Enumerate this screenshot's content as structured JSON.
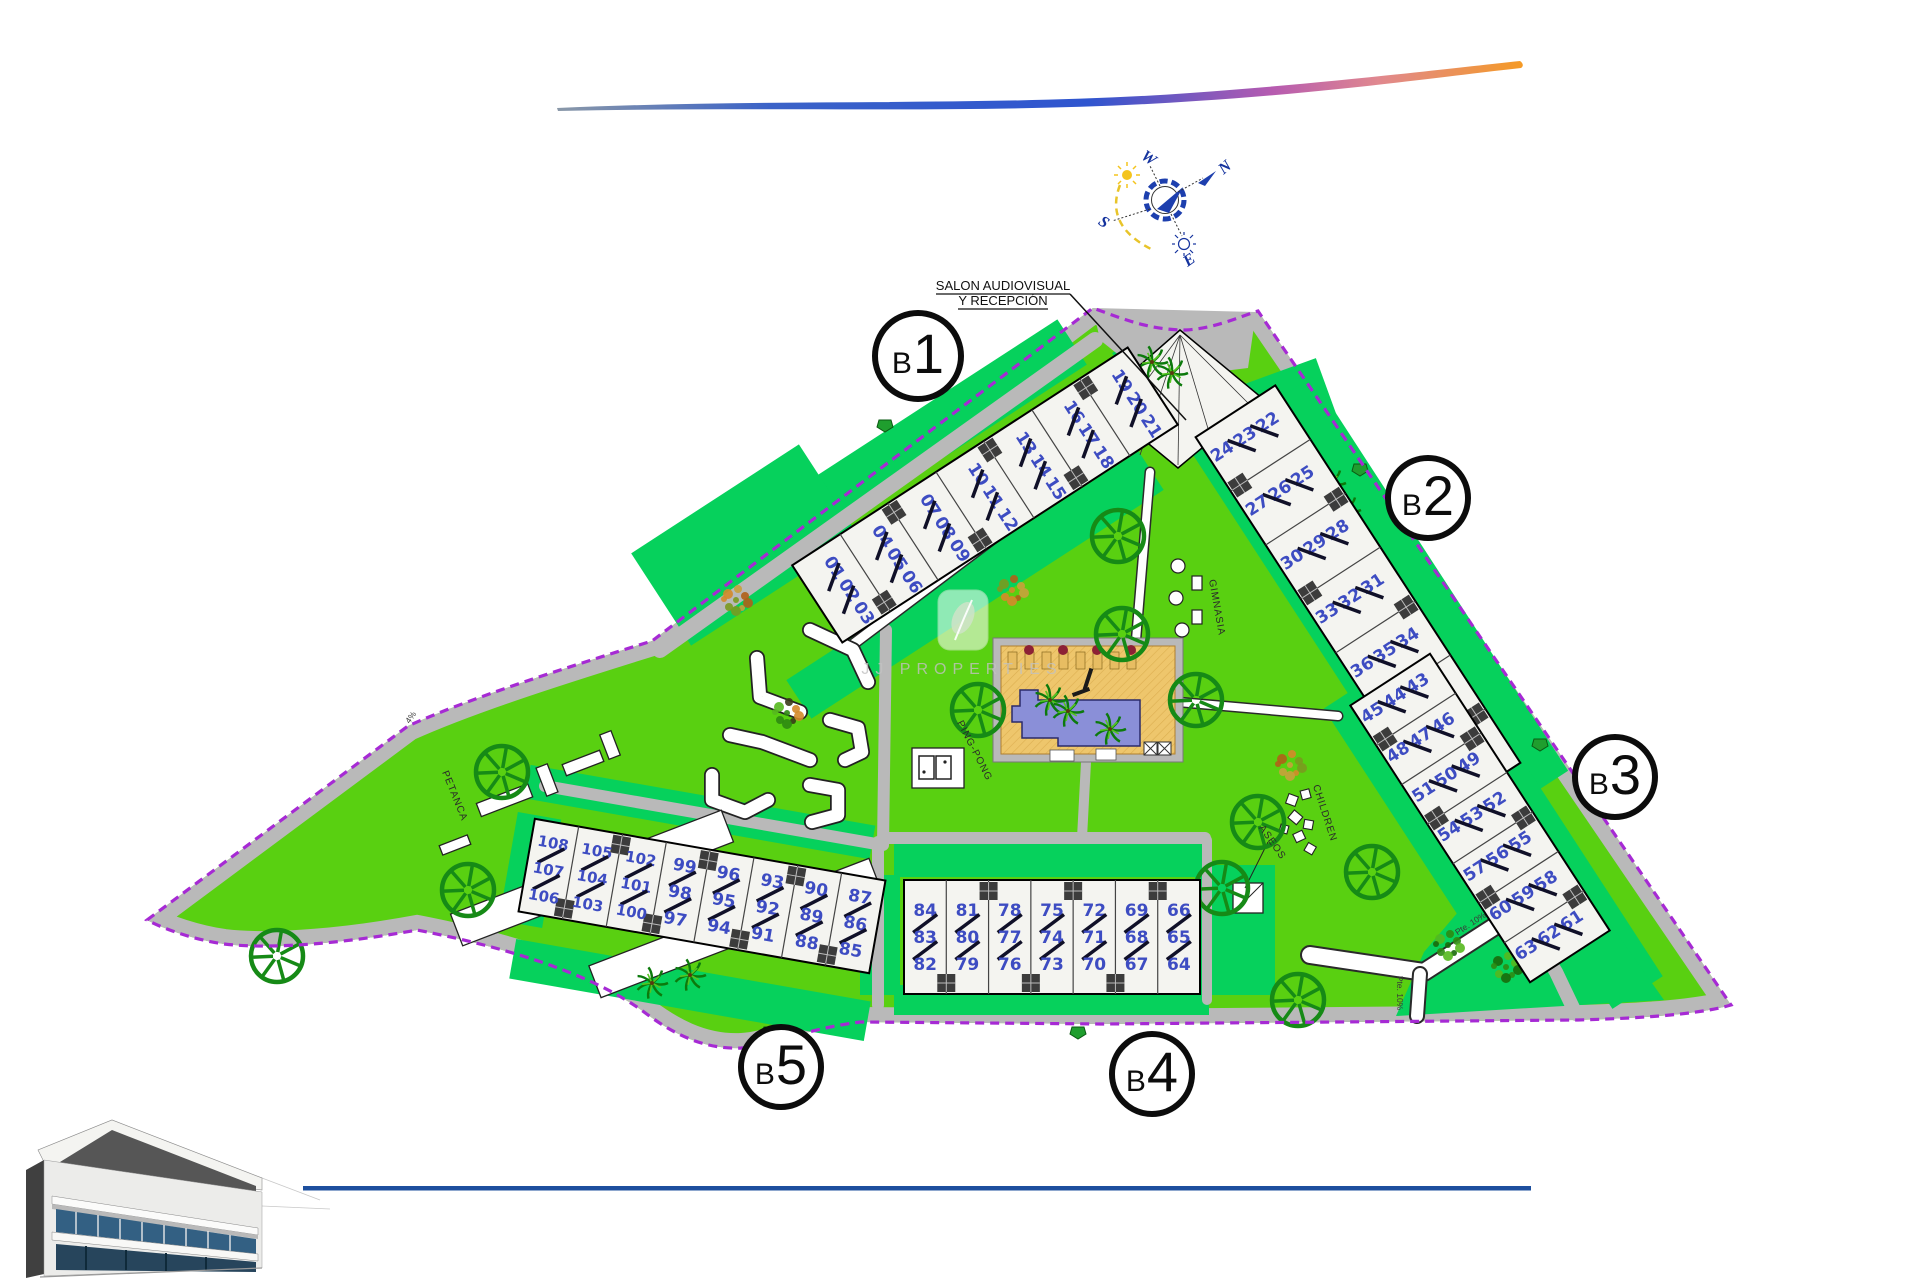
{
  "compass": {
    "n": "N",
    "w": "W",
    "s": "S",
    "e": "E"
  },
  "annotations": {
    "reception_line1": "SALON AUDIOVISUAL",
    "reception_line2": "Y RECEPCIÓN",
    "petanca": "PETANCA",
    "pingpong": "PING-PONG",
    "gimnasia": "GIMNASIA",
    "children": "CHILDREN",
    "aseos": "ASEOS"
  },
  "watermark": {
    "text": "JJ PROPERTIES"
  },
  "road_labels": [
    {
      "text": "Pte. 10%",
      "x": 1472,
      "y": 926,
      "r": -33
    },
    {
      "text": "Pte. 10%",
      "x": 1397,
      "y": 993,
      "r": 90
    },
    {
      "text": "4%",
      "x": 413,
      "y": 719,
      "r": -55
    }
  ],
  "site": {
    "lawn_color": "#59d011",
    "garden_color": "#06d15c",
    "road_color": "#b9b9b9",
    "boundary_color": "#a62ad4",
    "building_fill": "#f4f4f0",
    "unit_number_color": "#3d4cc2",
    "pool_water_color": "#8a8fd8",
    "pool_deck_color": "#eec66c",
    "footer_line_color": "#1d4f9e"
  },
  "blocks": [
    {
      "id": "b1",
      "label": "B1",
      "circle": {
        "x": 918,
        "y": 356,
        "r": 43
      },
      "cx": 985,
      "cy": 495,
      "len": 400,
      "wid": 92,
      "angle": -33,
      "numRot": 90,
      "triplets": [
        [
          "01",
          "02",
          "03"
        ],
        [
          "04",
          "05",
          "06"
        ],
        [
          "07",
          "08",
          "09"
        ],
        [
          "10",
          "11",
          "12"
        ],
        [
          "13",
          "14",
          "15"
        ],
        [
          "16",
          "17",
          "18"
        ],
        [
          "19",
          "20",
          "21"
        ]
      ]
    },
    {
      "id": "b2",
      "label": "B2",
      "circle": {
        "x": 1428,
        "y": 498,
        "r": 40
      },
      "cx": 1358,
      "cy": 600,
      "len": 450,
      "wid": 95,
      "angle": 57,
      "numRot": -90,
      "triplets": [
        [
          "22",
          "23",
          "24"
        ],
        [
          "25",
          "26",
          "27"
        ],
        [
          "28",
          "29",
          "30"
        ],
        [
          "31",
          "32",
          "33"
        ],
        [
          "34",
          "35",
          "36"
        ],
        [
          "37",
          "38",
          "39"
        ],
        [
          "40",
          "41",
          "42"
        ]
      ]
    },
    {
      "id": "b3",
      "label": "B3",
      "circle": {
        "x": 1615,
        "y": 777,
        "r": 40
      },
      "cx": 1480,
      "cy": 818,
      "len": 330,
      "wid": 95,
      "angle": 57,
      "numRot": -90,
      "triplets": [
        [
          "43",
          "44",
          "45"
        ],
        [
          "46",
          "47",
          "48"
        ],
        [
          "49",
          "50",
          "51"
        ],
        [
          "52",
          "53",
          "54"
        ],
        [
          "55",
          "56",
          "57"
        ],
        [
          "58",
          "59",
          "60"
        ],
        [
          "61",
          "62",
          "63"
        ]
      ]
    },
    {
      "id": "b4",
      "label": "B4",
      "circle": {
        "x": 1152,
        "y": 1074,
        "r": 40
      },
      "cx": 1052,
      "cy": 937,
      "len": 296,
      "wid": 114,
      "angle": 0,
      "numRot": 0,
      "triplets": [
        [
          "84",
          "83",
          "82"
        ],
        [
          "81",
          "80",
          "79"
        ],
        [
          "78",
          "77",
          "76"
        ],
        [
          "75",
          "74",
          "73"
        ],
        [
          "72",
          "71",
          "70"
        ],
        [
          "69",
          "68",
          "67"
        ],
        [
          "66",
          "65",
          "64"
        ]
      ]
    },
    {
      "id": "b5",
      "label": "B5",
      "circle": {
        "x": 781,
        "y": 1067,
        "r": 40
      },
      "cx": 702,
      "cy": 896,
      "len": 356,
      "wid": 94,
      "angle": 10,
      "numRot": 0,
      "triplets": [
        [
          "108",
          "107",
          "106"
        ],
        [
          "105",
          "104",
          "103"
        ],
        [
          "102",
          "101",
          "100"
        ],
        [
          "99",
          "98",
          "97"
        ],
        [
          "96",
          "95",
          "94"
        ],
        [
          "93",
          "92",
          "91"
        ],
        [
          "90",
          "89",
          "88"
        ],
        [
          "87",
          "86",
          "85"
        ]
      ]
    }
  ],
  "landscape": {
    "trees": [
      [
        916,
        533
      ],
      [
        1118,
        536
      ],
      [
        978,
        710
      ],
      [
        1122,
        634
      ],
      [
        1196,
        700
      ],
      [
        1258,
        822
      ],
      [
        1372,
        872
      ],
      [
        1298,
        1000
      ],
      [
        502,
        772
      ],
      [
        468,
        890
      ],
      [
        277,
        956
      ],
      [
        1222,
        888
      ]
    ],
    "palms": [
      [
        1152,
        362
      ],
      [
        1172,
        373
      ],
      [
        1330,
        483
      ],
      [
        1345,
        510
      ],
      [
        1050,
        700
      ],
      [
        1068,
        711
      ],
      [
        1110,
        729
      ],
      [
        1000,
        952
      ],
      [
        1040,
        950
      ],
      [
        690,
        975
      ],
      [
        652,
        983
      ],
      [
        575,
        903
      ]
    ],
    "bushes": [
      {
        "x": 1012,
        "y": 590,
        "t": "orange"
      },
      {
        "x": 1290,
        "y": 765,
        "t": "orange"
      },
      {
        "x": 736,
        "y": 600,
        "t": "orange"
      },
      {
        "x": 620,
        "y": 877,
        "t": "mixed"
      },
      {
        "x": 787,
        "y": 713,
        "t": "mixed"
      },
      {
        "x": 1448,
        "y": 945,
        "t": "green"
      },
      {
        "x": 1506,
        "y": 967,
        "t": "green"
      }
    ],
    "entry_markers": [
      [
        885,
        424
      ],
      [
        1360,
        468
      ],
      [
        1540,
        743
      ],
      [
        1078,
        1031
      ],
      [
        770,
        1031
      ]
    ]
  }
}
